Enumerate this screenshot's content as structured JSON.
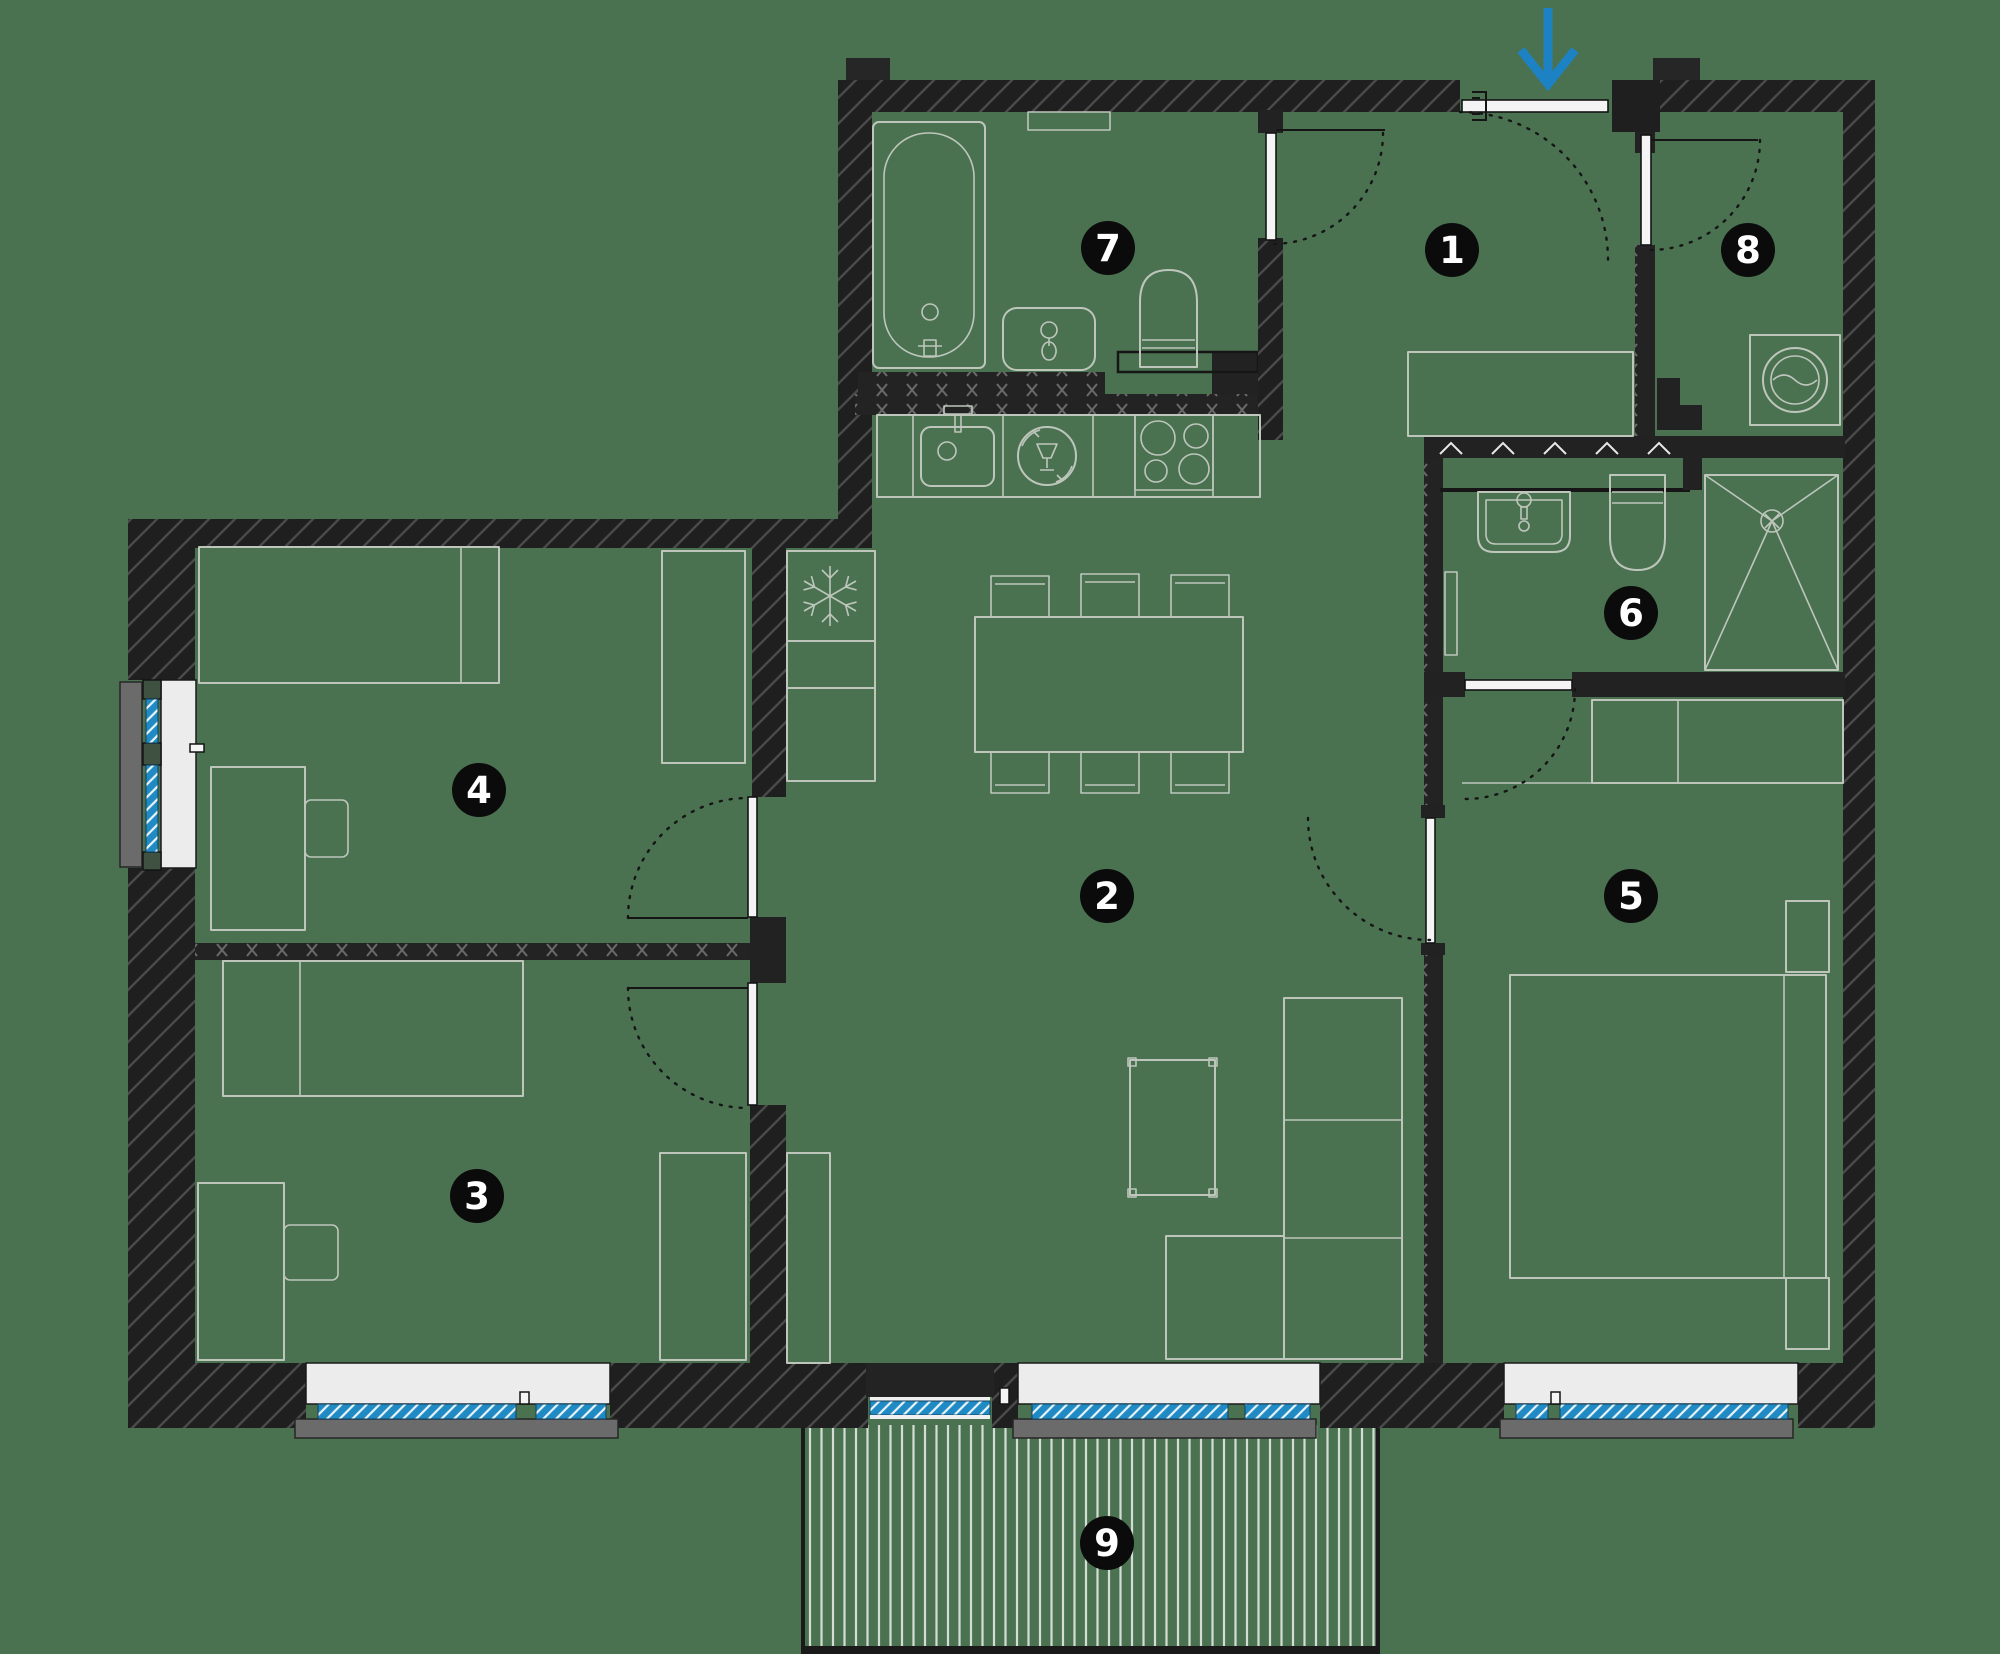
{
  "title": "apartment-floor-plan",
  "canvas": {
    "width": 2000,
    "height": 1654,
    "background": "#4a7251"
  },
  "colors": {
    "wall_dark": "#1f1f1f",
    "wall_hatch_line": "#4a4a4a",
    "partition_x_line": "#6a6a6a",
    "furniture_line": "#bec6bc",
    "window_glass_blue": "#1f8ac4",
    "glass_hatch_white": "#eaf4fb",
    "window_recess_white": "#ececec",
    "sill_gray": "#6b6b6b",
    "deck_stripe": "#d5dcd4",
    "badge_background": "#0b0b0b",
    "badge_text": "#ffffff",
    "entrance_arrow_blue": "#1d82c4",
    "door_swing_arc": "#151515"
  },
  "entrance": {
    "icon": "entrance-arrow-down",
    "direction": "down"
  },
  "rooms": [
    {
      "number": "1",
      "zone": "hallway"
    },
    {
      "number": "2",
      "zone": "living-dining-kitchen"
    },
    {
      "number": "3",
      "zone": "bedroom"
    },
    {
      "number": "4",
      "zone": "bedroom"
    },
    {
      "number": "5",
      "zone": "bedroom"
    },
    {
      "number": "6",
      "zone": "shower-bathroom"
    },
    {
      "number": "7",
      "zone": "bathtub-bathroom"
    },
    {
      "number": "8",
      "zone": "utility-room"
    },
    {
      "number": "9",
      "zone": "terrace"
    }
  ],
  "fixture_icons": [
    "bathtub-icon",
    "washbasin-icon",
    "toilet-icon",
    "mirror-icon",
    "kitchen-sink-icon",
    "dishwasher-icon",
    "cooktop-icon",
    "refrigerator-snowflake-icon",
    "dining-table-icon",
    "chair-icon",
    "bed-icon",
    "nightstand-icon",
    "desk-icon",
    "wardrobe-icon",
    "sofa-icon",
    "coffee-table-icon",
    "shower-tray-icon",
    "washing-machine-icon",
    "radiator-icon",
    "terrace-decking-icon",
    "door-swing-icon"
  ]
}
